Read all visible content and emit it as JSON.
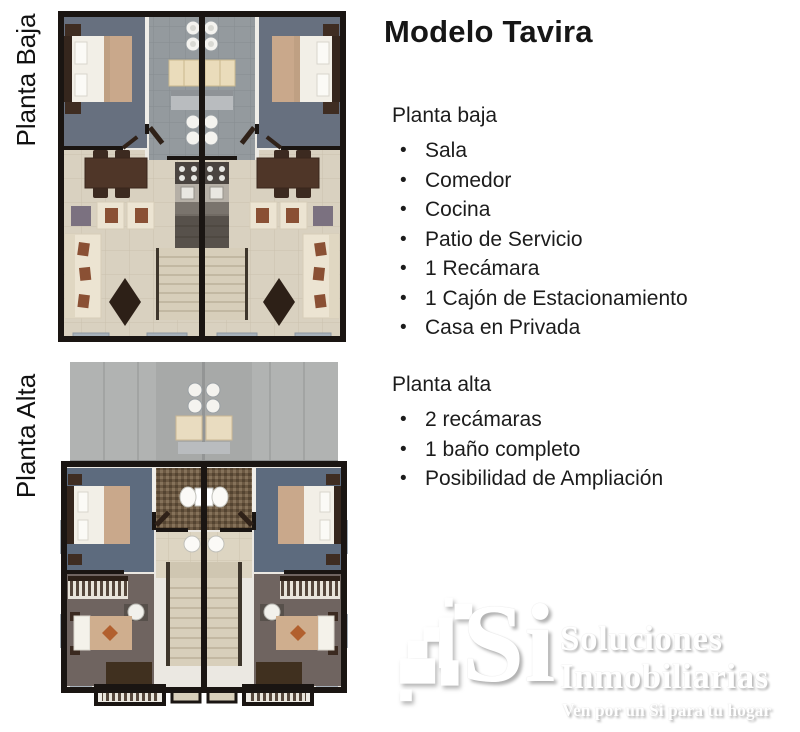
{
  "title": "Modelo Tavira",
  "plan_labels": {
    "baja": "Planta Baja",
    "alta": "Planta Alta"
  },
  "planta_baja": {
    "heading": "Planta baja",
    "items": [
      "Sala",
      "Comedor",
      "Cocina",
      "Patio de Servicio",
      "1 Recámara",
      "1 Cajón de Estacionamiento",
      "Casa en Privada"
    ]
  },
  "planta_alta": {
    "heading": "Planta alta",
    "items": [
      "2 recámaras",
      "1 baño completo",
      "Posibilidad de Ampliación"
    ]
  },
  "logo": {
    "mark_text": "Si",
    "name_line1": "Soluciones",
    "name_line2": "Inmobiliarias",
    "tagline": "Ven por un Si para tu hogar"
  },
  "colors": {
    "text": "#1c1c1c",
    "background": "#ffffff",
    "wall_black": "#1a1512",
    "carpet_blue": "#67707f",
    "carpet_taupe": "#6f6460",
    "floor_beige": "#d9d1c0",
    "patio_gray": "#949a9e",
    "roof_gray": "#b1b3b2",
    "bathroom_brown": "#6b5842",
    "bed_blanket_tan": "#c9a88b",
    "wood_dark": "#3b2a20",
    "sofa_cream": "#ece4d2",
    "accent_rust": "#8a5034",
    "window_blue": "#a7b1ba",
    "logo_white": "#ffffff",
    "logo_shadow": "#b9b9b9"
  }
}
